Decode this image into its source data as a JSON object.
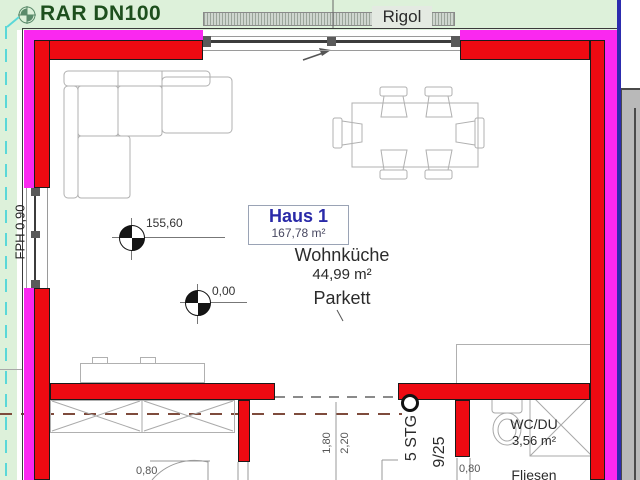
{
  "site": {
    "drain_label": "RAR DN100",
    "trench_label": "Rigol",
    "parapet_label": "FPH 0,90"
  },
  "building": {
    "name": "Haus 1",
    "total_area": "167,78 m²"
  },
  "rooms": {
    "living_kitchen": {
      "name": "Wohnküche",
      "area": "44,99 m²",
      "floor": "Parkett"
    },
    "wc": {
      "name": "WC/DU",
      "area": "3,56 m²",
      "floor": "Fliesen"
    }
  },
  "stairs": {
    "line1": "5 STG",
    "line2": "9/25"
  },
  "levels": {
    "upper": "155,60",
    "lower": "0,00"
  },
  "dimensions": {
    "door_left": "0,80",
    "opening_width": "1,80",
    "opening_height": "2,20",
    "door_wc": "0,80"
  },
  "colors": {
    "wall_inner": "#ee0a12",
    "wall_outer": "#fa28f0",
    "site_green": "#ddf1da",
    "text_green": "#1d4f1d",
    "cyan": "#5ad8d8",
    "blue_line": "#2c2cae",
    "panel_gray": "#b9b9b9",
    "rigol_gray": "#cfd6cf",
    "furniture_gray": "#b0b0b0",
    "dash_brown": "#7e4b3c",
    "haus_blue": "#2a2aa8",
    "text_dark": "#2b2b2b"
  }
}
